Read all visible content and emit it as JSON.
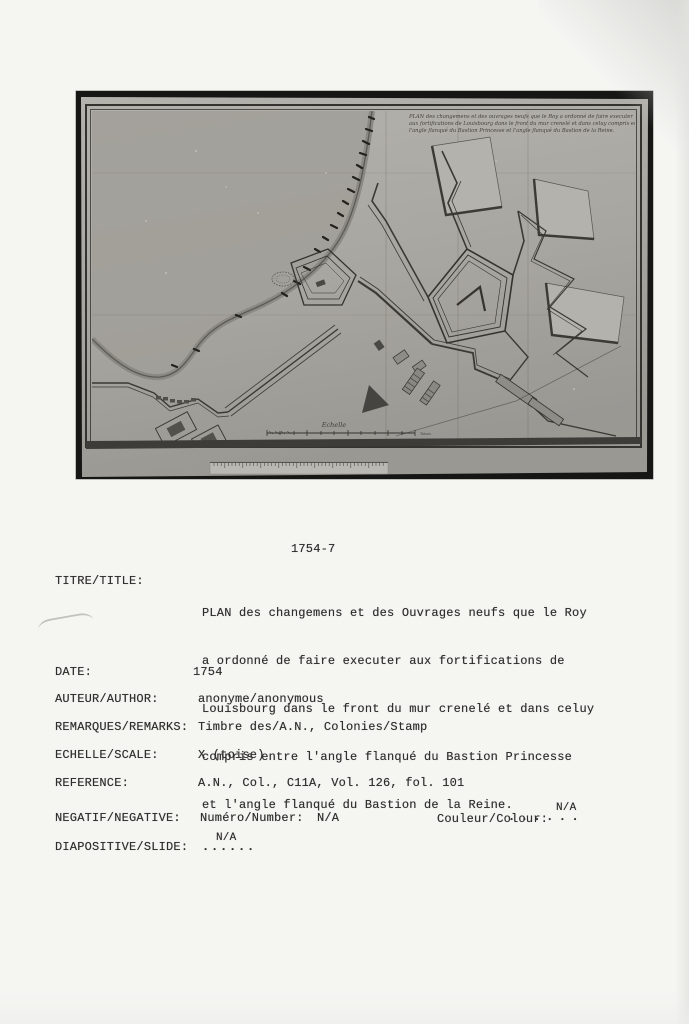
{
  "card": {
    "heading": "1754-7",
    "title": {
      "label": "TITRE/TITLE:",
      "lines": [
        "PLAN des changemens et des Ouvrages neufs que le Roy",
        "a ordonné de faire executer aux fortifications de",
        "Louisbourg dans le front du mur crenelé et dans celuy",
        "compris entre l'angle flanqué du Bastion Princesse",
        "et l'angle flanqué du Bastion de la Reine."
      ]
    },
    "date": {
      "label": "DATE:",
      "value": "1754"
    },
    "author": {
      "label": "AUTEUR/AUTHOR:",
      "value": "anonyme/anonymous"
    },
    "remarks": {
      "label": "REMARQUES/REMARKS:",
      "value": "Timbre des/A.N., Colonies/Stamp"
    },
    "scale": {
      "label": "ECHELLE/SCALE:",
      "value": "X (toise)"
    },
    "reference": {
      "label": "REFERENCE:",
      "value": "A.N., Col., C11A, Vol. 126, fol. 101"
    },
    "negative": {
      "label": "NEGATIF/NEGATIVE:",
      "number_label": "Numéro/Number:",
      "number_value": "N/A",
      "colour_label": "Couleur/Colour:",
      "colour_dots": "......",
      "colour_value": "N/A"
    },
    "slide": {
      "label": "DIAPOSITIVE/SLIDE:",
      "value": "N/A",
      "dots": "......"
    }
  },
  "photo": {
    "inscription": {
      "line1": "PLAN des changemens et des ouvrages neufs que le Roy a ordonné de faire executer",
      "line2": "aux fortifications de Louisbourg dans le front du mur crenelé et dans celuy compris entre",
      "line3": "l'angle flanqué du Bastion Princesse et l'angle flanqué du Bastion de la Reine."
    },
    "scale_label": "Echelle",
    "scale_unit": "Toises",
    "colors": {
      "frame_black": "#161614",
      "paper_gray": "#a9a7a1",
      "ink": "#34332f"
    }
  }
}
